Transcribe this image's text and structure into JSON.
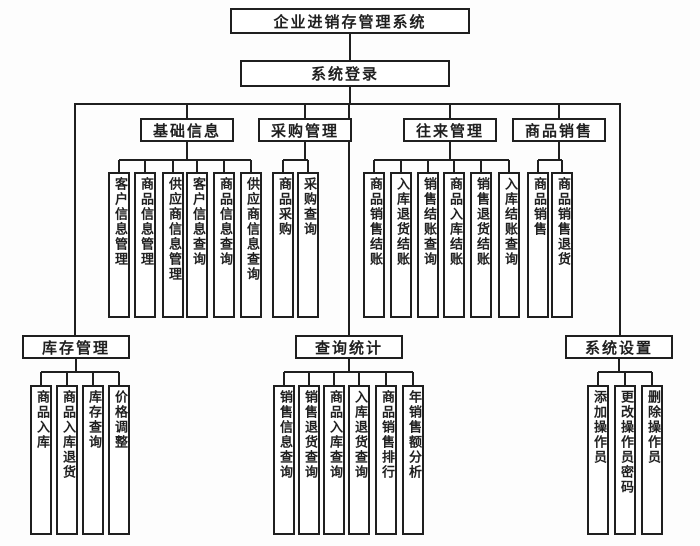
{
  "diagram": {
    "title": "企业进销存管理系统",
    "login": "系统登录"
  },
  "groups": [
    {
      "label": "基础信息",
      "children": [
        "客户信息管理",
        "商品信息管理",
        "供应商信息管理",
        "客户信息查询",
        "商品信息查询",
        "供应商信息查询"
      ]
    },
    {
      "label": "采购管理",
      "children": [
        "商品采购",
        "采购查询"
      ]
    },
    {
      "label": "往来管理",
      "children": [
        "商品销售结账",
        "入库退货结账",
        "销售结账查询",
        "商品入库结账",
        "销售退货结账",
        "入库结账查询"
      ]
    },
    {
      "label": "商品销售",
      "children": [
        "商品销售",
        "商品销售退货"
      ]
    },
    {
      "label": "库存管理",
      "children": [
        "商品入库",
        "商品入库退货",
        "库存查询",
        "价格调整"
      ]
    },
    {
      "label": "查询统计",
      "children": [
        "销售信息查询",
        "销售退货查询",
        "商品入库查询",
        "入库退货查询",
        "商品销售排行",
        "年销售额分析"
      ]
    },
    {
      "label": "系统设置",
      "children": [
        "添加操作员",
        "更改操作员密码",
        "删除操作员"
      ]
    }
  ]
}
